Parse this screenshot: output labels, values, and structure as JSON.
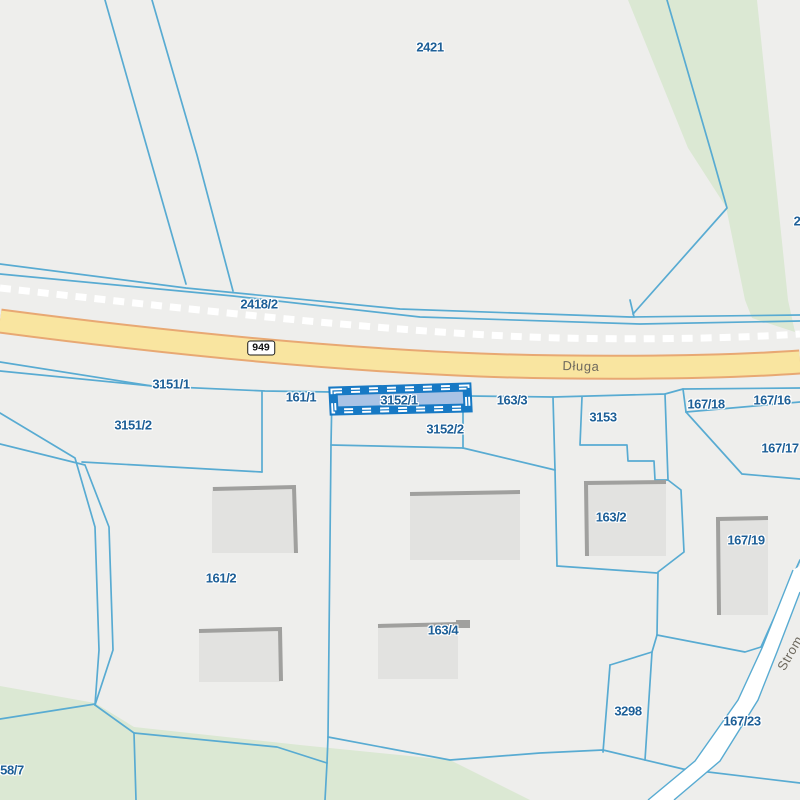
{
  "map": {
    "description": "cadastral parcel map with selected parcel",
    "selected_parcel_id": "3152/1",
    "road_shield": {
      "text": "949",
      "x": 261,
      "y": 348
    },
    "street_labels": [
      {
        "text": "Długa",
        "x": 581,
        "y": 366,
        "rotate": 1.5
      },
      {
        "text": "Strom",
        "x": 790,
        "y": 653,
        "rotate": -60
      }
    ],
    "parcel_labels": [
      {
        "text": "2421",
        "x": 430,
        "y": 47
      },
      {
        "text": "2418/2",
        "x": 259,
        "y": 304
      },
      {
        "text": "3151/1",
        "x": 171,
        "y": 384
      },
      {
        "text": "161/1",
        "x": 301,
        "y": 397
      },
      {
        "text": "3152/1",
        "x": 399,
        "y": 400
      },
      {
        "text": "163/3",
        "x": 512,
        "y": 400
      },
      {
        "text": "167/18",
        "x": 706,
        "y": 404
      },
      {
        "text": "167/16",
        "x": 772,
        "y": 400
      },
      {
        "text": "3153",
        "x": 603,
        "y": 417
      },
      {
        "text": "3151/2",
        "x": 133,
        "y": 425
      },
      {
        "text": "3152/2",
        "x": 445,
        "y": 429
      },
      {
        "text": "167/17",
        "x": 780,
        "y": 448
      },
      {
        "text": "163/2",
        "x": 611,
        "y": 517
      },
      {
        "text": "167/19",
        "x": 746,
        "y": 540
      },
      {
        "text": "161/2",
        "x": 221,
        "y": 578
      },
      {
        "text": "163/4",
        "x": 443,
        "y": 630
      },
      {
        "text": "3298",
        "x": 628,
        "y": 711
      },
      {
        "text": "167/23",
        "x": 742,
        "y": 721
      },
      {
        "text": "58/7",
        "x": 12,
        "y": 770
      },
      {
        "text": "2",
        "x": 797,
        "y": 221
      }
    ],
    "colors": {
      "background": "#eeeeec",
      "green_area": "#dbe8d3",
      "parcel_line": "#58abd2",
      "label_text": "#1d5f97",
      "road_fill": "#f9e5a0",
      "road_border": "#e8a873",
      "railway_dash": "#ffffff",
      "white_road": "#ffffff",
      "building_fill": "#e2e2e0",
      "building_shadow": "#a0a09e",
      "selected_fill": "#a9c3e5",
      "selected_border": "#1779c4"
    }
  }
}
